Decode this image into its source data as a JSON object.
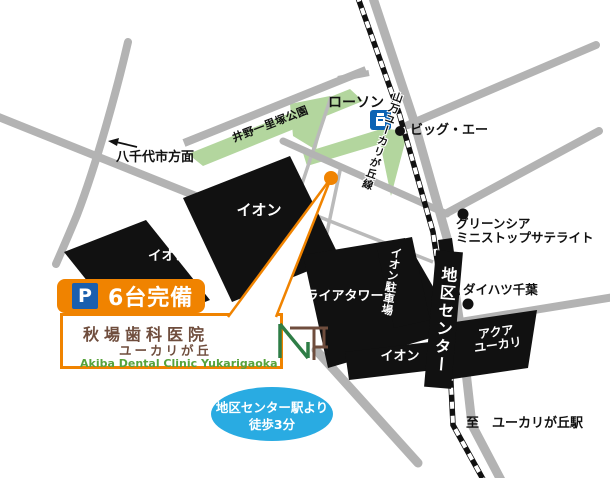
{
  "labels": {
    "lawson": "ローソン",
    "big_a": "ビッグ・エー",
    "greencia_1": "グリーンシア",
    "greencia_2": "ミニストップサテライト",
    "daihatsu": "ダイハツ千葉",
    "yachiyo": "八千代市方面",
    "park": "井野一里塚公園",
    "rail_line": "山万ユーカリが丘線",
    "station": "地区センター",
    "to_station": "至　ユーカリが丘駅",
    "aeon_big": "イオン",
    "aeon_small": "イオン",
    "aeon_bottom": "イオン",
    "aeon_parking": "イオン駐車場",
    "miraia": "ミライアタワー",
    "aqua_1": "アクア",
    "aqua_2": "ユーカリ"
  },
  "parking_badge": {
    "p": "P",
    "label": "6台完備"
  },
  "clinic": {
    "name_line1": "秋場歯科医院",
    "name_line2": "ユーカリが丘",
    "romaji": "Akiba Dental Clinic Yukarigaoka"
  },
  "access_note": {
    "line1": "地区センター駅より",
    "line2": "徒歩3分"
  },
  "colors": {
    "orange": "#f08300",
    "road_gray": "#b3b3b3",
    "park_green": "#b3d69e",
    "building_black": "#111111",
    "lawson_blue": "#0b63b4",
    "p_square_blue": "#1a5fae",
    "access_blue": "#29abe2",
    "clinic_brown": "#6f4d3d",
    "romaji_green": "#57a33c"
  }
}
